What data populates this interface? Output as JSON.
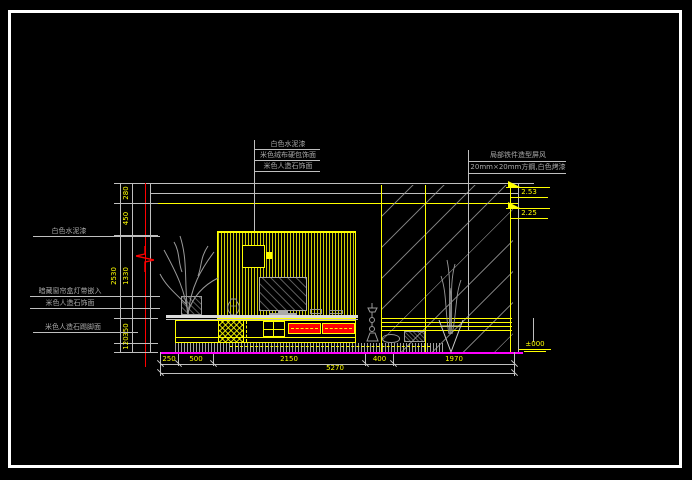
{
  "labels": {
    "top": [
      "白色水泥漆",
      "米色绒布硬包饰面",
      "米色人造石饰面"
    ],
    "right": [
      "局部铁件造型屏风",
      "20mm×20mm方鋼,白色烤漆"
    ],
    "left": [
      "白色水泥漆",
      "暗藏窗帘盒灯带嵌入",
      "米色人造石饰面",
      "米色人造石踢脚面"
    ]
  },
  "dimensions": {
    "left_chain": [
      "280",
      "450",
      "1330",
      "350",
      "120"
    ],
    "left_overall": "2530",
    "bottom_chain": [
      "250",
      "500",
      "2150",
      "400",
      "1970"
    ],
    "bottom_overall": "5270"
  },
  "levels": {
    "ceiling_upper": "2.53",
    "ceiling_lower": "2.25",
    "floor": "±000"
  },
  "colors": {
    "background": "#000000",
    "frame": "#ffffff",
    "outline": "#ffff00",
    "dimension_text": "#ffff00",
    "drawing_line": "#bfbfbf",
    "label_text": "#a8a8a8",
    "accent_red": "#ff0000",
    "floor_level_line": "#ff00ff"
  }
}
